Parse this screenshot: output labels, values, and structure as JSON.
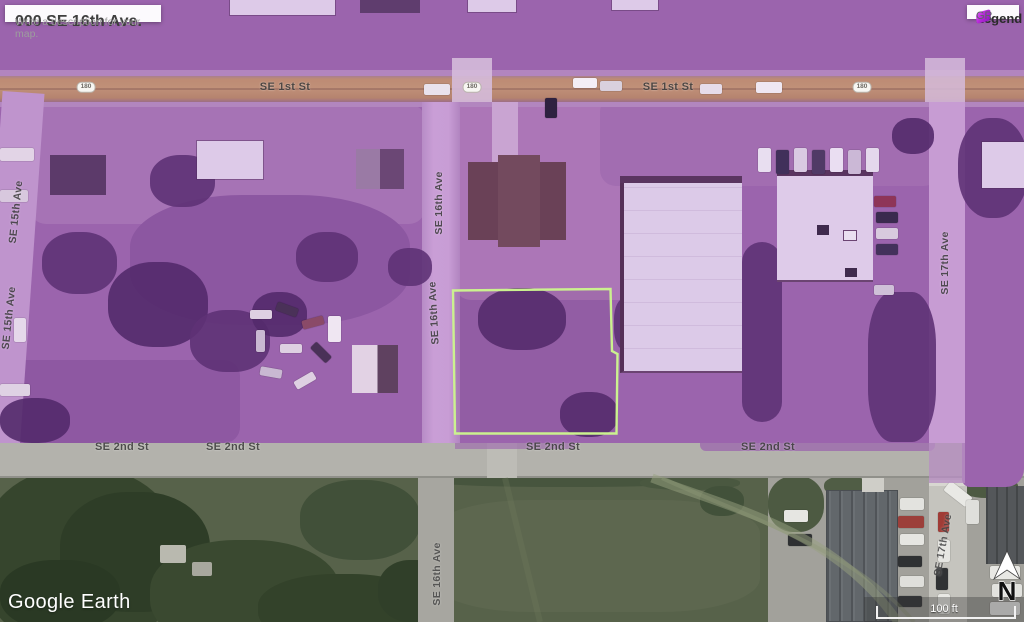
{
  "info_card": {
    "title": "000 SE 16th Ave.",
    "description": "Write a description for your map."
  },
  "legend": {
    "title": "Legend",
    "items": [
      {
        "label": "GR",
        "swatch_color": "#b429d6"
      }
    ]
  },
  "map": {
    "labels": {
      "se_1st_st": "SE 1st St",
      "se_2nd_st": "SE 2nd St",
      "se_15th_ave": "SE 15th Ave",
      "se_16th_ave": "SE 16th Ave",
      "se_17th_ave": "SE 17th Ave",
      "highway_shield": "180"
    },
    "overlay": {
      "zone_label": "GR",
      "overlay_color": "#9b64ad",
      "parcel_outline_color": "#cbf18f"
    }
  },
  "attribution": {
    "text": "Google Earth"
  },
  "scale_bar": {
    "label": "100 ft"
  },
  "compass": {
    "label": "N"
  }
}
